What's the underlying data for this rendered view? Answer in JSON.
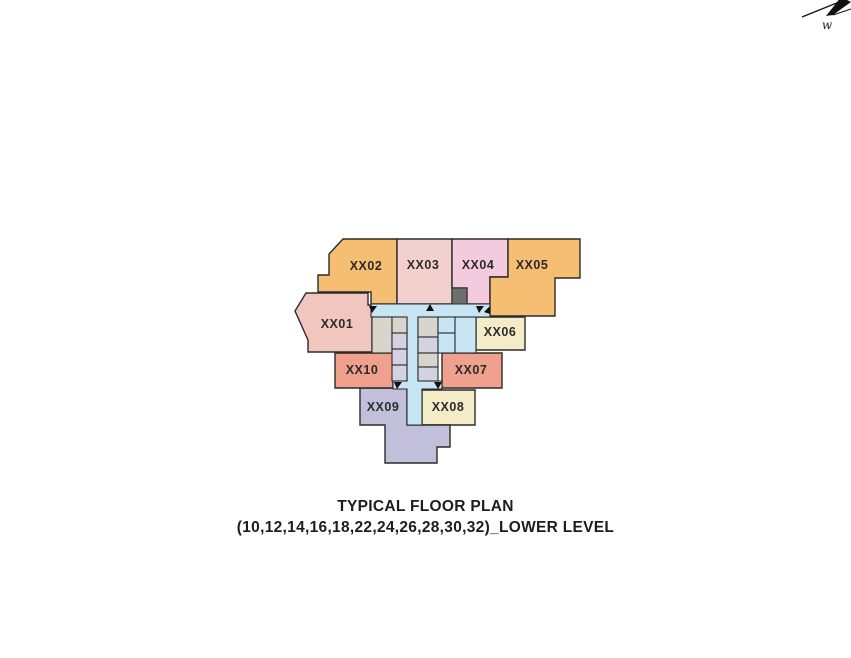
{
  "compass": {
    "cardinal_label": "w"
  },
  "plan_title": {
    "line1": "TYPICAL FLOOR PLAN",
    "line2": "(10,12,14,16,18,22,24,26,28,30,32)_LOWER LEVEL"
  },
  "palette": {
    "background": "#FFFFFF",
    "border": "#2B2B2B",
    "label_text": "#2B2B2B",
    "title_text": "#1D1D1D",
    "corridor_blue": "#C8E5F3",
    "room_gray": "#D8D5CC",
    "room_lavender": "#D4D1E3",
    "service_dark": "#6E6E6E",
    "unit_orange": "#F6BE72",
    "unit_rose": "#F2D0CE",
    "unit_pink": "#F4CBDE",
    "unit_salmon_light": "#F1C6BE",
    "unit_salmon": "#EFA18E",
    "unit_cream": "#F3ECC6",
    "unit_lavender": "#C2BFDB"
  },
  "floor_plan": {
    "units": [
      {
        "id": "XX01",
        "label": "XX01",
        "color": "#F1C6BE",
        "points": "306,293 368,293 368,305 372,305 372,352 308,352 308,340 295,311",
        "label_x": 337,
        "label_y": 328
      },
      {
        "id": "XX02",
        "label": "XX02",
        "color": "#F6BE72",
        "points": "343,239 397,239 397,304 371,304 371,292 318,292 318,275 329,275 329,254",
        "label_x": 366,
        "label_y": 270
      },
      {
        "id": "XX03",
        "label": "XX03",
        "color": "#F2D0CE",
        "points": "397,239 452,239 452,304 397,304",
        "label_x": 423,
        "label_y": 269
      },
      {
        "id": "XX04",
        "label": "XX04",
        "color": "#F4CBDE",
        "points": "452,239 508,239 508,277 490,277 490,304 467,304 467,288 452,288",
        "label_x": 478,
        "label_y": 269
      },
      {
        "id": "XX05",
        "label": "XX05",
        "color": "#F6BE72",
        "points": "508,239 580,239 580,278 555,278 555,316 490,316 490,277 508,277",
        "label_x": 532,
        "label_y": 269
      },
      {
        "id": "XX06",
        "label": "XX06",
        "color": "#F3ECC6",
        "points": "476,317 525,317 525,350 476,350",
        "label_x": 500,
        "label_y": 336
      },
      {
        "id": "XX07",
        "label": "XX07",
        "color": "#EFA18E",
        "points": "442,353 502,353 502,388 442,388",
        "label_x": 471,
        "label_y": 374
      },
      {
        "id": "XX08",
        "label": "XX08",
        "color": "#F3ECC6",
        "points": "422,390 475,390 475,425 422,425",
        "label_x": 448,
        "label_y": 411
      },
      {
        "id": "XX09",
        "label": "XX09",
        "color": "#C2BFDB",
        "points": "360,388 407,388 407,425 450,425 450,447 437,447 437,463 385,463 385,425 360,425",
        "label_x": 383,
        "label_y": 411
      },
      {
        "id": "XX10",
        "label": "XX10",
        "color": "#EFA18E",
        "points": "335,353 393,353 393,388 335,388",
        "label_x": 362,
        "label_y": 374
      }
    ],
    "corridor": {
      "color": "#C8E5F3",
      "points": "371,304 490,304 490,317 418,317 418,381 442,381 442,389 422,389 422,425 407,425 407,389 393,389 393,381 407,381 407,317 371,317"
    },
    "core_rooms": [
      {
        "x": 372,
        "y": 317,
        "w": 20,
        "h": 36,
        "color": "#D8D5CC"
      },
      {
        "x": 392,
        "y": 317,
        "w": 15,
        "h": 16,
        "color": "#D8D5CC"
      },
      {
        "x": 392,
        "y": 333,
        "w": 15,
        "h": 16,
        "color": "#D4D1E3"
      },
      {
        "x": 392,
        "y": 349,
        "w": 15,
        "h": 16,
        "color": "#D4D1E3"
      },
      {
        "x": 392,
        "y": 365,
        "w": 15,
        "h": 16,
        "color": "#D4D1E3"
      },
      {
        "x": 418,
        "y": 317,
        "w": 20,
        "h": 20,
        "color": "#D8D5CC"
      },
      {
        "x": 418,
        "y": 337,
        "w": 20,
        "h": 16,
        "color": "#D4D1E3"
      },
      {
        "x": 418,
        "y": 353,
        "w": 20,
        "h": 14,
        "color": "#D8D5CC"
      },
      {
        "x": 418,
        "y": 367,
        "w": 20,
        "h": 14,
        "color": "#D4D1E3"
      },
      {
        "x": 438,
        "y": 317,
        "w": 17,
        "h": 16,
        "color": "#C8E5F3"
      },
      {
        "x": 438,
        "y": 333,
        "w": 17,
        "h": 20,
        "color": "#C8E5F3"
      },
      {
        "x": 455,
        "y": 317,
        "w": 21,
        "h": 36,
        "color": "#C8E5F3"
      }
    ],
    "service_block": {
      "x": 452,
      "y": 288,
      "w": 15,
      "h": 16,
      "color": "#6E6E6E"
    },
    "door_arrows": [
      {
        "points": "369,306 377,306 372,313"
      },
      {
        "points": "426,311 430,304 434,311"
      },
      {
        "points": "476,306 484,306 479,313"
      },
      {
        "points": "484,312 490,306 490,314"
      },
      {
        "points": "394,382 402,382 397,389"
      },
      {
        "points": "434,382 442,382 438,389"
      }
    ]
  }
}
